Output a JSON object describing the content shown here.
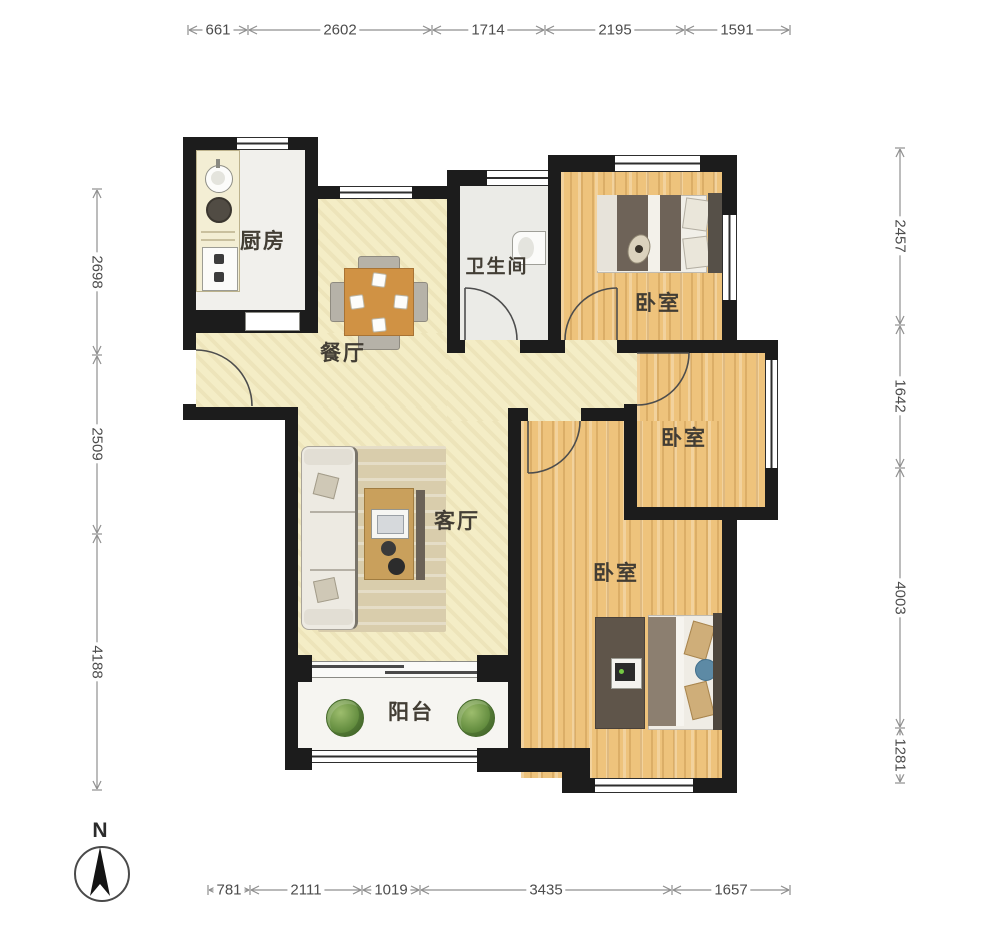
{
  "plan": {
    "rooms": [
      {
        "key": "kitchen",
        "label": "厨房"
      },
      {
        "key": "dining",
        "label": "餐厅"
      },
      {
        "key": "bathroom",
        "label": "卫生间"
      },
      {
        "key": "bedroom_top",
        "label": "卧室"
      },
      {
        "key": "bedroom_middle",
        "label": "卧室"
      },
      {
        "key": "bedroom_bottom",
        "label": "卧室"
      },
      {
        "key": "living",
        "label": "客厅"
      },
      {
        "key": "balcony",
        "label": "阳台"
      }
    ]
  },
  "dimensions": {
    "top": [
      "661",
      "2602",
      "1714",
      "2195",
      "1591"
    ],
    "left": [
      "2698",
      "2509",
      "4188"
    ],
    "right": [
      "2457",
      "1642",
      "4003",
      "1281"
    ],
    "bottom": [
      "781",
      "2111",
      "1019",
      "3435",
      "1657"
    ]
  },
  "compass": {
    "label": "N"
  },
  "colors": {
    "wall": "#1c1c1c",
    "floor_main": "#f4edc6",
    "floor_wood": "#eec37c",
    "floor_tile": "#f1f0ec",
    "table": "#d09244",
    "plant_green": "#668f41"
  }
}
